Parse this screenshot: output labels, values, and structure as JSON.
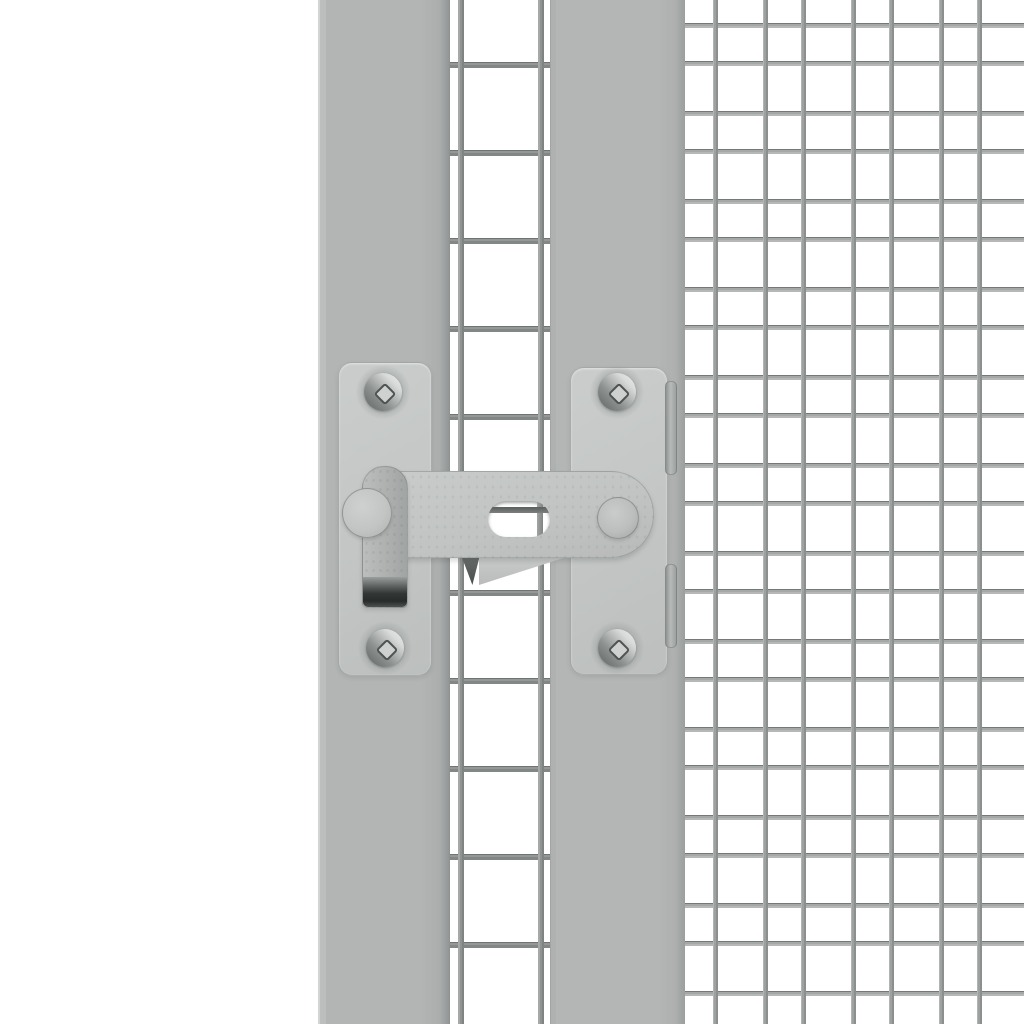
{
  "scene": {
    "description": "Close-up 3D product render of a grey metal gate latch (slotted bar latch with drop handle) mounted between two grey square frame posts of a wire-mesh enclosure door; a fine welded wire grid panel fills the right side and a coarser wire grid shows between the posts; plain white background; no text anywhere in the image.",
    "background_color": "#ffffff"
  },
  "palette": {
    "background": "#ffffff",
    "post_grey": "#b2b5b4",
    "post_edge_highlight": "#d2d4d3",
    "post_edge_shadow": "#8a8e8d",
    "plate_grey": "#c4c7c6",
    "bar_grey": "#c1c4c3",
    "handle_grey": "#adb0af",
    "handle_lip_dark": "#2a2e2d",
    "washer_grey": "#c6c9c8",
    "knob_grey": "#bcbfbe",
    "screw_light": "#eceeed",
    "screw_dark": "#5f6463",
    "screw_drive_fill": "#ced1d0",
    "screw_drive_outline": "#4f5453",
    "mesh_wire_right": "#a4a8a7",
    "mesh_wire_middle": "#8a8e8d",
    "wedge_dark": "#4a4e4d",
    "wedge_light": "#c9ccca"
  },
  "parts": {
    "frame_post_left": "vertical grey frame post",
    "frame_post_right": "vertical grey frame post (door stile)",
    "mounting_plate_left": "rounded latch mounting plate with two screws",
    "mounting_plate_right": "rounded latch mounting plate with two screws and edge clips",
    "latch_bar": "horizontal slotted latch bar",
    "latch_handle": "drop handle with dark folded grip lip",
    "pivot_washer": "round pivot washer on left plate",
    "pin_knob": "round pin head at right end of bar",
    "screws": [
      "top-left",
      "top-right",
      "bottom-left",
      "bottom-right"
    ],
    "screw_drive": "square/phillips recess",
    "catch_wedges": "bent catch lip visible under the bar"
  },
  "meshes": {
    "right": {
      "width": 340,
      "height": 1024,
      "period": 88,
      "wire_thickness": 5,
      "vertical_offsets": [
        29,
        79
      ],
      "horizontal_offsets": [
        23,
        61
      ]
    },
    "middle": {
      "width": 120,
      "height": 1024,
      "verticals": [
        18,
        98
      ],
      "horizontal_start": 62,
      "horizontal_period": 88,
      "horizontal_count": 11,
      "wire_thickness": 6
    }
  }
}
